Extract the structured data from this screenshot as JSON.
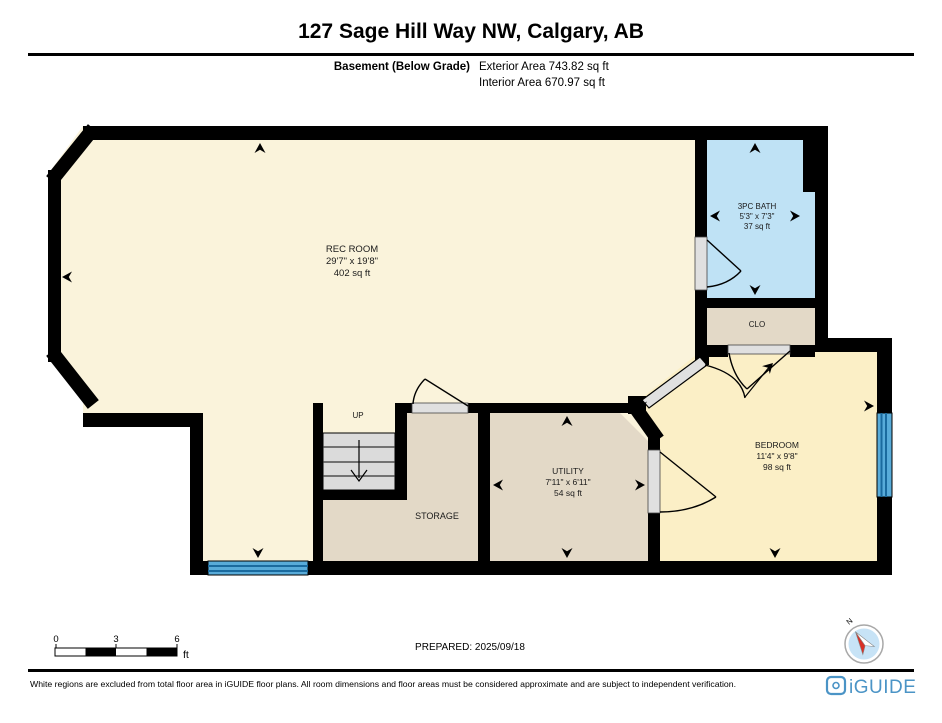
{
  "header": {
    "title": "127 Sage Hill Way NW, Calgary, AB",
    "floor_label": "Basement (Below Grade)",
    "exterior_area": "Exterior Area 743.82 sq ft",
    "interior_area": "Interior Area 670.97 sq ft"
  },
  "rooms": {
    "rec_room": {
      "name": "REC ROOM",
      "dims": "29'7\" x 19'8\"",
      "area": "402 sq ft"
    },
    "bath": {
      "name": "3PC BATH",
      "dims": "5'3\" x 7'3\"",
      "area": "37 sq ft"
    },
    "closet": {
      "name": "CLO"
    },
    "bedroom": {
      "name": "BEDROOM",
      "dims": "11'4\" x 9'8\"",
      "area": "98 sq ft"
    },
    "utility": {
      "name": "UTILITY",
      "dims": "7'11\" x 6'11\"",
      "area": "54 sq ft"
    },
    "storage": {
      "name": "STORAGE"
    },
    "stairs": {
      "label": "UP"
    }
  },
  "scale_bar": {
    "ticks": [
      "0",
      "3",
      "6"
    ],
    "unit": "ft"
  },
  "prepared": "PREPARED: 2025/09/18",
  "compass": {
    "label": "N"
  },
  "footer": {
    "disclaimer": "White regions are excluded from total floor area in iGUIDE floor plans. All room dimensions and floor areas must be considered approximate and are subject to independent verification.",
    "brand": "iGUIDE"
  },
  "colors": {
    "wall": "#000000",
    "rec_room_fill": "#FAF3DB",
    "bedroom_fill": "#FBEFC6",
    "bath_fill": "#BFE2F5",
    "utility_fill": "#E3D9C7",
    "stairs_fill": "#DBDBDB",
    "window_fill": "#58ABD9",
    "window_line": "#1A6A9E",
    "door_sill": "#E0E0E0",
    "brand_blue": "#4B94C6",
    "compass_fill": "#C7E3F6",
    "compass_needle_red": "#D93025"
  }
}
